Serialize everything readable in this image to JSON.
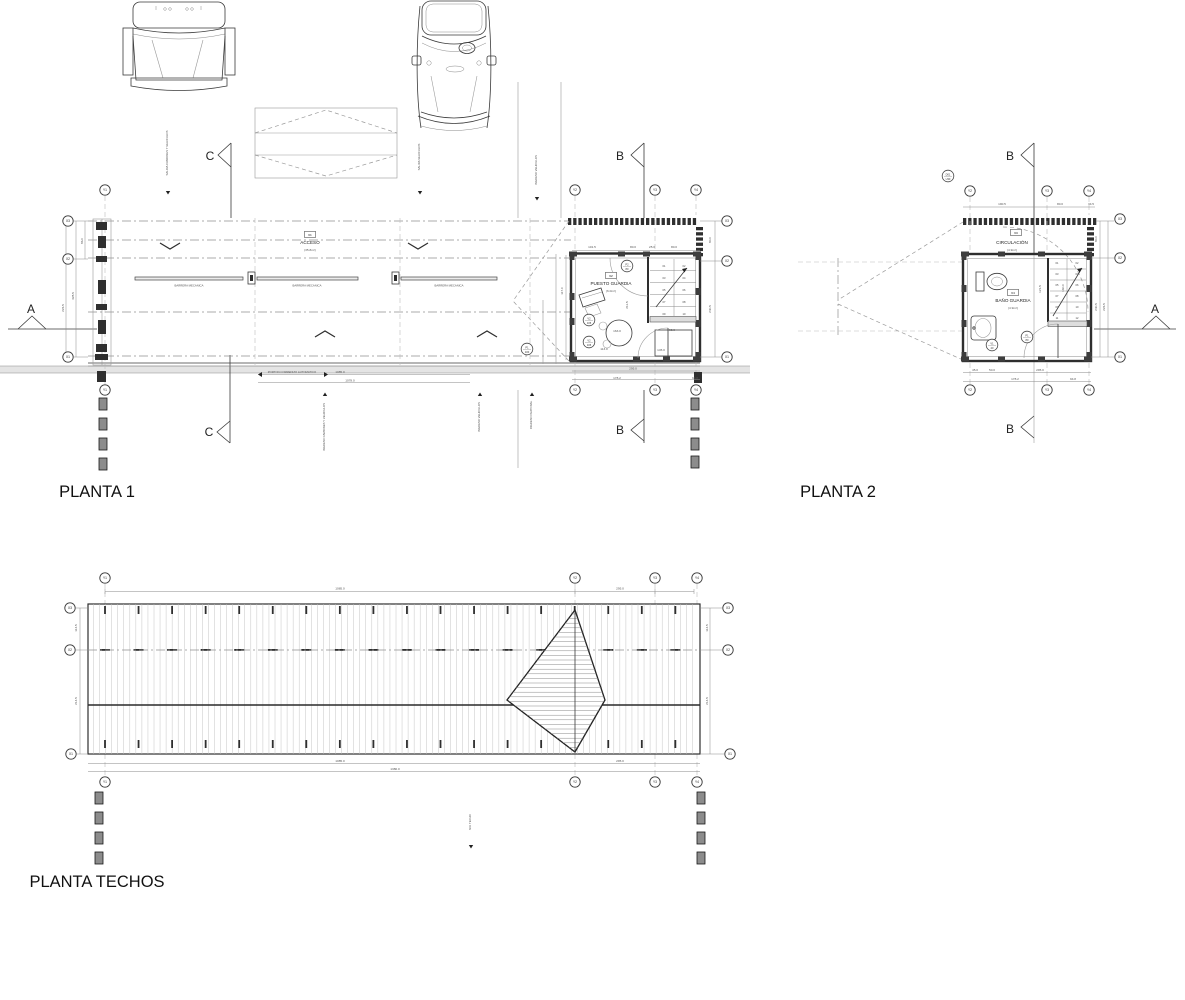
{
  "colors": {
    "line": "#3a3a3a",
    "dark_fill": "#2f2f2f",
    "road_band": "#e4e4e4",
    "background": "#ffffff"
  },
  "titles": [
    {
      "t": "PLANTA 1"
    },
    {
      "t": "PLANTA 2"
    },
    {
      "t": "PLANTA TECHOS"
    }
  ],
  "sections": [
    {
      "t": "C",
      "x": 210,
      "y": 160
    },
    {
      "t": "C",
      "x": 209,
      "y": 436
    },
    {
      "t": "B",
      "x": 620,
      "y": 160
    },
    {
      "t": "B",
      "x": 620,
      "y": 434
    },
    {
      "t": "B",
      "x": 1010,
      "y": 160
    },
    {
      "t": "B",
      "x": 1010,
      "y": 433
    },
    {
      "t": "A",
      "x": 31,
      "y": 313
    },
    {
      "t": "A",
      "x": 1155,
      "y": 313
    }
  ],
  "planta1": {
    "labels": [
      {
        "t": "BARRERA MECANICA",
        "x": 189,
        "y": 286.5,
        "s": "s7"
      },
      {
        "t": "BARRERA MECANICA",
        "x": 307,
        "y": 286.5,
        "s": "s7"
      },
      {
        "t": "BARRERA MECANICA",
        "x": 449,
        "y": 286.5,
        "s": "s7"
      },
      {
        "t": "ACCESO",
        "x": 310,
        "y": 244,
        "s": "s3"
      },
      {
        "t": "(35.8m²)",
        "x": 310,
        "y": 251,
        "s": "s1"
      },
      {
        "t": "PUESTO GUARDIA",
        "x": 611,
        "y": 285,
        "s": "s3"
      },
      {
        "t": "(6.0m²)",
        "x": 611,
        "y": 292,
        "s": "s1"
      },
      {
        "t": "PORTON CORREDIZO AUTOMATICO",
        "x": 292,
        "y": 373,
        "s": "s7"
      }
    ],
    "boxes": [
      {
        "t": "01",
        "x": 310,
        "y": 236
      },
      {
        "t": "02",
        "x": 611,
        "y": 277
      }
    ],
    "dims": [
      {
        "t": "101.5",
        "x": 592,
        "y": 248
      },
      {
        "t": "80.0",
        "x": 633,
        "y": 248
      },
      {
        "t": "25.0",
        "x": 652,
        "y": 248
      },
      {
        "t": "80.0",
        "x": 674,
        "y": 248
      },
      {
        "t": "86.0",
        "x": 83,
        "y": 241,
        "r": -90
      },
      {
        "t": "328.5",
        "x": 74,
        "y": 296,
        "r": -90
      },
      {
        "t": "226.5",
        "x": 64,
        "y": 308,
        "r": -90
      },
      {
        "t": "117.0",
        "x": 563,
        "y": 291,
        "r": -90
      },
      {
        "t": "80.0",
        "x": 711,
        "y": 240,
        "r": -90
      },
      {
        "t": "240.5",
        "x": 711,
        "y": 309,
        "r": -90
      },
      {
        "t": "211.5",
        "x": 628,
        "y": 305,
        "r": -90
      },
      {
        "t": "163.0",
        "x": 617,
        "y": 332
      },
      {
        "t": "113.0",
        "x": 604,
        "y": 350
      },
      {
        "t": "145.0",
        "x": 661,
        "y": 351
      },
      {
        "t": "95.0",
        "x": 672,
        "y": 331
      },
      {
        "t": "295.0",
        "x": 633,
        "y": 369.5
      },
      {
        "t": "178.2",
        "x": 617,
        "y": 379
      },
      {
        "t": "94.8",
        "x": 695,
        "y": 379
      },
      {
        "t": "1085.0",
        "x": 340,
        "y": 373
      },
      {
        "t": "1078.0",
        "x": 350,
        "y": 381.5
      }
    ],
    "stair": [
      {
        "t": "01",
        "x": 664,
        "y": 267
      },
      {
        "t": "02",
        "x": 684,
        "y": 267
      },
      {
        "t": "03",
        "x": 664,
        "y": 279
      },
      {
        "t": "04",
        "x": 684,
        "y": 279
      },
      {
        "t": "05",
        "x": 664,
        "y": 291
      },
      {
        "t": "06",
        "x": 684,
        "y": 291
      },
      {
        "t": "07",
        "x": 664,
        "y": 303
      },
      {
        "t": "08",
        "x": 684,
        "y": 303
      },
      {
        "t": "09",
        "x": 664,
        "y": 315
      },
      {
        "t": "10",
        "x": 684,
        "y": 315
      }
    ],
    "tags": [
      {
        "a": "P2",
        "b": "80",
        "x": 627,
        "y": 266
      },
      {
        "a": "V2",
        "b": "105",
        "x": 589,
        "y": 320
      },
      {
        "a": "V2",
        "b": "105",
        "x": 589,
        "y": 342
      },
      {
        "a": "P1",
        "b": "100",
        "x": 527,
        "y": 349
      }
    ],
    "bubbles": [
      {
        "t": "Y1",
        "x": 105,
        "y": 190
      },
      {
        "t": "Y2",
        "x": 575,
        "y": 190
      },
      {
        "t": "Y3",
        "x": 655,
        "y": 190
      },
      {
        "t": "Y4",
        "x": 696,
        "y": 190
      },
      {
        "t": "Y1",
        "x": 105,
        "y": 390
      },
      {
        "t": "Y2",
        "x": 575,
        "y": 390
      },
      {
        "t": "Y3",
        "x": 655,
        "y": 390
      },
      {
        "t": "Y4",
        "x": 696,
        "y": 390
      },
      {
        "t": "X3",
        "x": 68,
        "y": 221
      },
      {
        "t": "X2",
        "x": 68,
        "y": 259
      },
      {
        "t": "X1",
        "x": 68,
        "y": 357
      },
      {
        "t": "X3",
        "x": 727,
        "y": 221
      },
      {
        "t": "X2",
        "x": 727,
        "y": 261
      },
      {
        "t": "X1",
        "x": 727,
        "y": 357
      }
    ],
    "flows": [
      {
        "t": "SALIDA CAMIONES Y VEHICULOS",
        "x": 168,
        "y": 153,
        "r": -90,
        "s": "s7"
      },
      {
        "t": "SALIDA VEHICULOS",
        "x": 420,
        "y": 157,
        "r": -90,
        "s": "s7"
      },
      {
        "t": "INGRESO VEHICULOS",
        "x": 537,
        "y": 170,
        "r": -90,
        "s": "s7"
      },
      {
        "t": "INGRESO CAMIONES Y VEHICULOS",
        "x": 325,
        "y": 427,
        "r": -90,
        "s": "s7"
      },
      {
        "t": "INGRESO VEHICULOS",
        "x": 480,
        "y": 417,
        "r": -90,
        "s": "s7"
      },
      {
        "t": "INGRESO PEATONAL",
        "x": 532,
        "y": 415,
        "r": -90,
        "s": "s7"
      }
    ]
  },
  "planta2": {
    "labels": [
      {
        "t": "CIRCULACIÓN",
        "x": 1012,
        "y": 244,
        "s": "s3"
      },
      {
        "t": "(4.9m²)",
        "x": 1012,
        "y": 251,
        "s": "s1"
      },
      {
        "t": "BAÑO GUARDIA",
        "x": 1013,
        "y": 302,
        "s": "s3"
      },
      {
        "t": "(4.9m²)",
        "x": 1013,
        "y": 309,
        "s": "s1"
      }
    ],
    "boxes": [
      {
        "t": "03",
        "x": 1016,
        "y": 234
      },
      {
        "t": "04",
        "x": 1013,
        "y": 294
      }
    ],
    "dims": [
      {
        "t": "190.5",
        "x": 1002,
        "y": 205
      },
      {
        "t": "80.0",
        "x": 1060,
        "y": 205
      },
      {
        "t": "34.5",
        "x": 1091,
        "y": 205
      },
      {
        "t": "45.0",
        "x": 975,
        "y": 371
      },
      {
        "t": "50.0",
        "x": 992,
        "y": 371
      },
      {
        "t": "295.0",
        "x": 1040,
        "y": 371
      },
      {
        "t": "178.2",
        "x": 1015,
        "y": 380
      },
      {
        "t": "94.8",
        "x": 1073,
        "y": 380
      },
      {
        "t": "80.0",
        "x": 1097,
        "y": 239,
        "r": -90
      },
      {
        "t": "240.5",
        "x": 1097,
        "y": 307,
        "r": -90
      },
      {
        "t": "226.5",
        "x": 1105,
        "y": 307,
        "r": -90
      },
      {
        "t": "121.5",
        "x": 1041,
        "y": 289,
        "r": -90
      },
      {
        "t": "160.0",
        "x": 1064,
        "y": 288,
        "r": -90
      }
    ],
    "stair": [
      {
        "t": "01",
        "x": 1057,
        "y": 264
      },
      {
        "t": "02",
        "x": 1077,
        "y": 264
      },
      {
        "t": "03",
        "x": 1057,
        "y": 275
      },
      {
        "t": "04",
        "x": 1077,
        "y": 275
      },
      {
        "t": "05",
        "x": 1057,
        "y": 286
      },
      {
        "t": "06",
        "x": 1077,
        "y": 286
      },
      {
        "t": "07",
        "x": 1057,
        "y": 297
      },
      {
        "t": "08",
        "x": 1077,
        "y": 297
      },
      {
        "t": "09",
        "x": 1057,
        "y": 308
      },
      {
        "t": "10",
        "x": 1077,
        "y": 308
      },
      {
        "t": "11",
        "x": 1057,
        "y": 319
      },
      {
        "t": "12",
        "x": 1077,
        "y": 319
      }
    ],
    "tags": [
      {
        "a": "P1",
        "b": "80",
        "x": 1027,
        "y": 337
      },
      {
        "a": "V1",
        "b": "40",
        "x": 992,
        "y": 345
      },
      {
        "a": "D01",
        "b": "U30",
        "x": 948,
        "y": 176
      }
    ],
    "bubbles": [
      {
        "t": "Y2",
        "x": 970,
        "y": 191
      },
      {
        "t": "Y3",
        "x": 1047,
        "y": 191
      },
      {
        "t": "Y4",
        "x": 1089,
        "y": 191
      },
      {
        "t": "Y2",
        "x": 970,
        "y": 390
      },
      {
        "t": "Y3",
        "x": 1047,
        "y": 390
      },
      {
        "t": "Y4",
        "x": 1089,
        "y": 390
      },
      {
        "t": "X3",
        "x": 1120,
        "y": 219
      },
      {
        "t": "X2",
        "x": 1120,
        "y": 258
      },
      {
        "t": "X1",
        "x": 1120,
        "y": 357
      }
    ],
    "flows": []
  },
  "techos": {
    "labels": [],
    "dims": [
      {
        "t": "1085.0",
        "x": 340,
        "y": 589.5
      },
      {
        "t": "295.0",
        "x": 620,
        "y": 589.5
      },
      {
        "t": "1085.0",
        "x": 340,
        "y": 762
      },
      {
        "t": "295.0",
        "x": 620,
        "y": 762
      },
      {
        "t": "1380.0",
        "x": 395,
        "y": 770
      },
      {
        "t": "114.5",
        "x": 77,
        "y": 628,
        "r": -90
      },
      {
        "t": "214.5",
        "x": 77,
        "y": 701,
        "r": -90
      },
      {
        "t": "114.5",
        "x": 708,
        "y": 628,
        "r": -90
      },
      {
        "t": "214.5",
        "x": 708,
        "y": 701,
        "r": -90
      }
    ],
    "bubbles": [
      {
        "t": "Y1",
        "x": 105,
        "y": 578
      },
      {
        "t": "Y2",
        "x": 575,
        "y": 578
      },
      {
        "t": "Y3",
        "x": 655,
        "y": 578
      },
      {
        "t": "Y4",
        "x": 697,
        "y": 578
      },
      {
        "t": "Y1",
        "x": 105,
        "y": 782
      },
      {
        "t": "Y2",
        "x": 575,
        "y": 782
      },
      {
        "t": "Y3",
        "x": 655,
        "y": 782
      },
      {
        "t": "Y4",
        "x": 697,
        "y": 782
      },
      {
        "t": "X3",
        "x": 70,
        "y": 608
      },
      {
        "t": "X2",
        "x": 70,
        "y": 650
      },
      {
        "t": "X1",
        "x": 71,
        "y": 754
      },
      {
        "t": "X3",
        "x": 728,
        "y": 608
      },
      {
        "t": "X2",
        "x": 728,
        "y": 650
      },
      {
        "t": "X1",
        "x": 730,
        "y": 754
      }
    ],
    "flows": [
      {
        "t": "NIV. TECHO",
        "x": 471,
        "y": 822,
        "r": -90,
        "s": "s7"
      }
    ]
  }
}
